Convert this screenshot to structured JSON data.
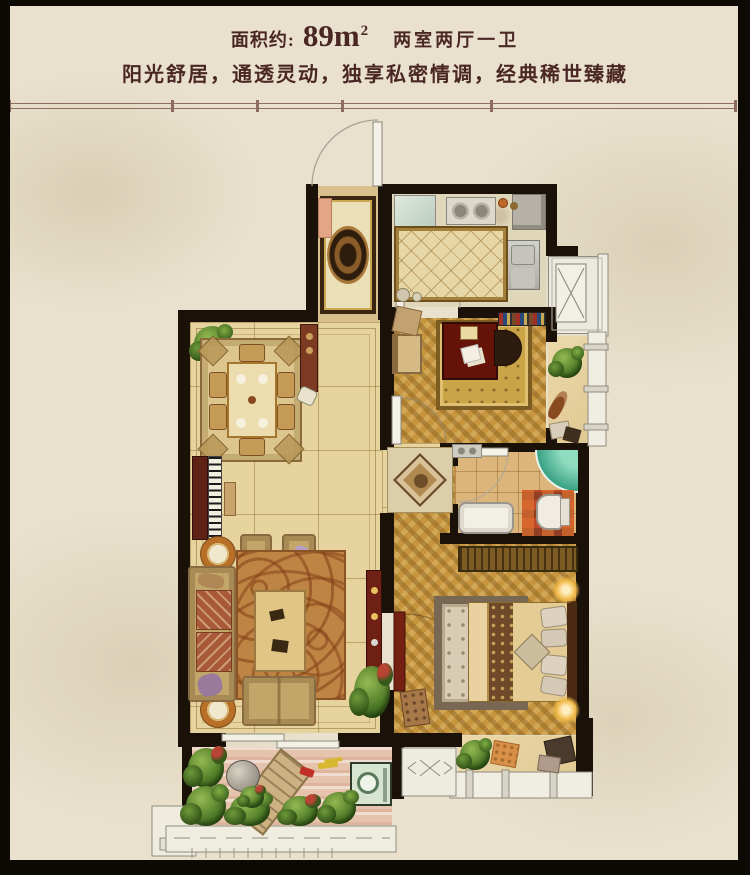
{
  "header": {
    "area_label": "面积约:",
    "area_value": "89m",
    "area_exponent": "2",
    "room_config": "两室两厅一卫",
    "tagline": "阳光舒居，通透灵动，独享私密情调，经典稀世臻藏"
  },
  "palette": {
    "text": "#4a2723",
    "background": "#e9e1cd",
    "frame": "#0d0a06",
    "wall": "#1a1209",
    "divider": "#8d6c5f",
    "marble_floor": "#e7d39d",
    "wood_floor": "#c6953d",
    "bath_floor": "#dcb57a",
    "kitchen_floor": "#e0d6ba",
    "balcony_floor": "#ecd0bd",
    "accent_wood_red": "#6e2014",
    "shower_teal": "#35a183",
    "plant_green": "#4e7a27"
  },
  "plan": {
    "rooms": [
      "entry-hall",
      "kitchen",
      "utility-balcony",
      "study-bedroom",
      "living-dining-room",
      "hallway",
      "bathroom",
      "master-bedroom",
      "south-balcony",
      "bay-window",
      "ac-platform"
    ]
  }
}
